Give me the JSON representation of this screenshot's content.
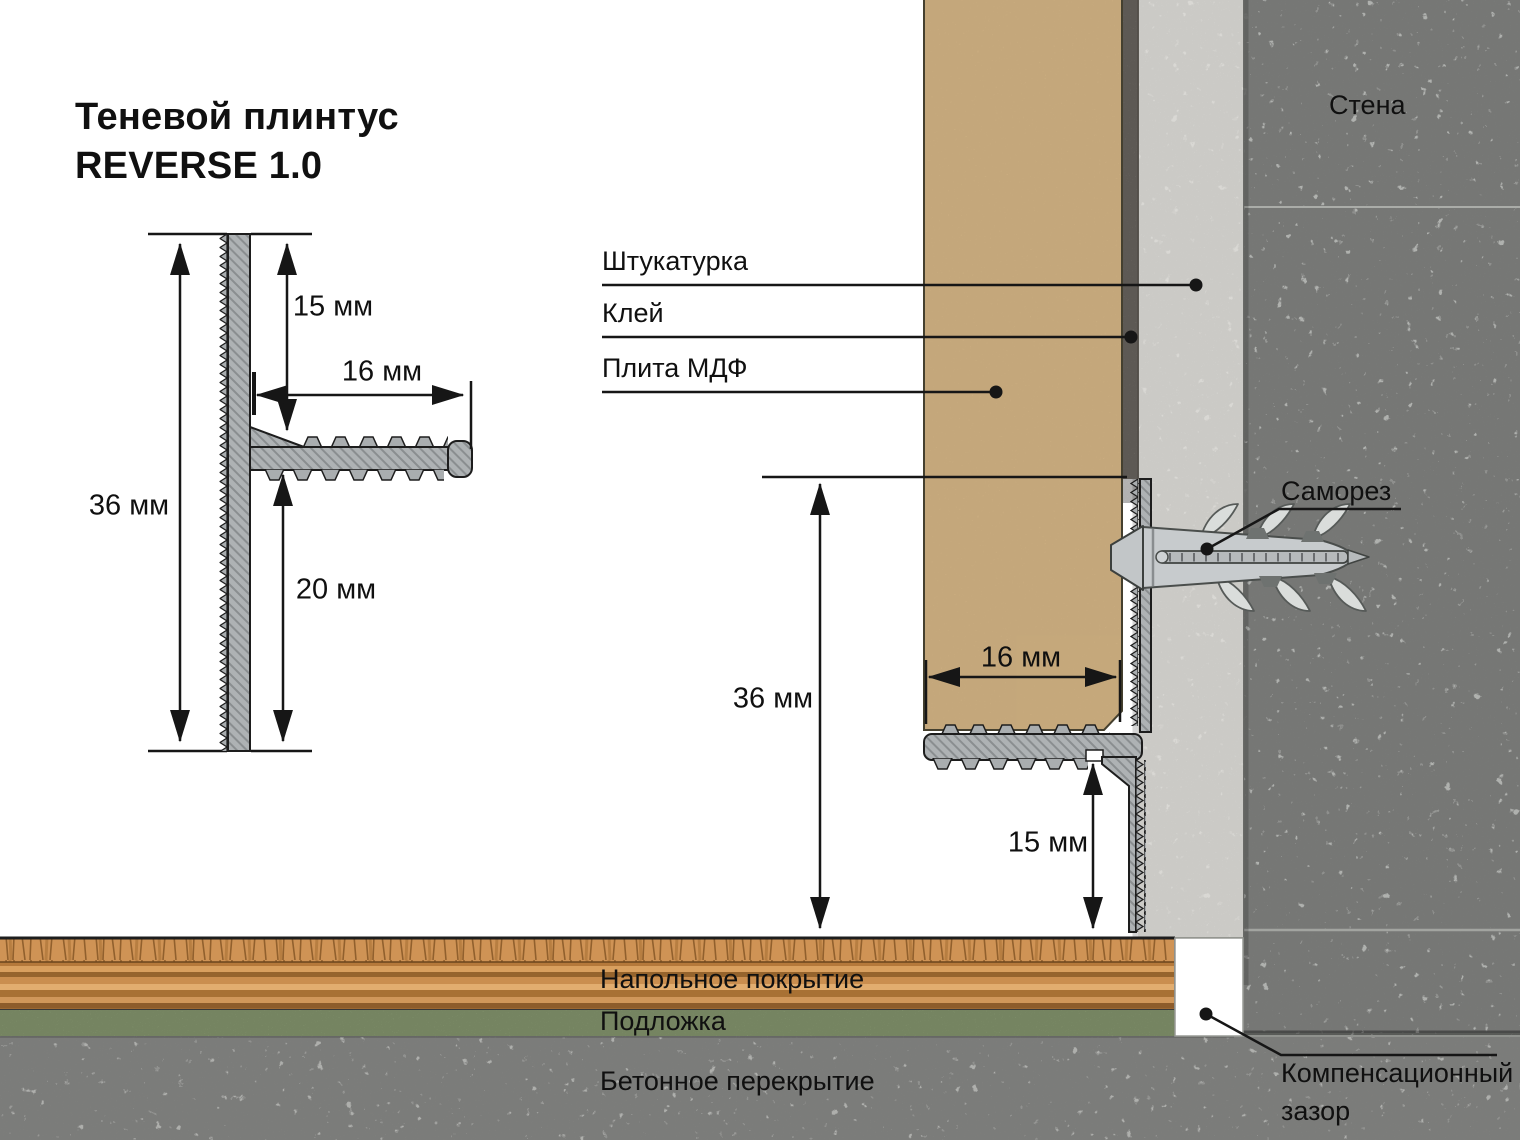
{
  "title": {
    "line1": "Теневой плинтус",
    "line2": "REVERSE 1.0"
  },
  "profile_view": {
    "total_height": "36 мм",
    "top_offset": "15 мм",
    "arm_length": "16 мм",
    "bottom_offset": "20 мм"
  },
  "installation": {
    "wall": "Стена",
    "plaster": "Штукатурка",
    "glue": "Клей",
    "mdf": "Плита МДФ",
    "screw": "Саморез",
    "profile_height": "36 мм",
    "mdf_thickness": "16 мм",
    "shadow_gap": "15 мм",
    "floor": "Напольное покрытие",
    "underlay": "Подложка",
    "slab": "Бетонное перекрытие",
    "gap_line1": "Компенсационный",
    "gap_line2": "зазор"
  },
  "colors": {
    "mdf": "#dcbb8e",
    "glue": "#87817a",
    "plaster": "#f3f2ee",
    "wall": "#c9cbc7",
    "slab": "#c5c6c2",
    "profile": "#aeb2b4",
    "wood": "#cf9355",
    "underlay": "#a3b888",
    "line": "#161616"
  }
}
